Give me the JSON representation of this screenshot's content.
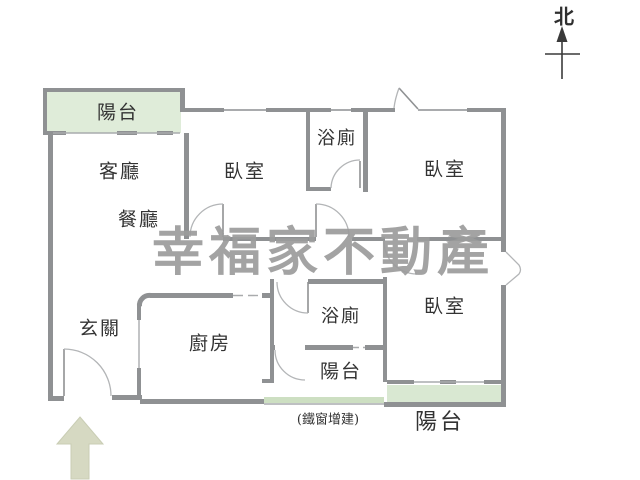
{
  "compass": {
    "label": "北"
  },
  "watermark": {
    "text": "幸福家不動產"
  },
  "rooms": {
    "balcony_top": "陽台",
    "living": "客廳",
    "dining": "餐廳",
    "bedroom_top_left": "臥室",
    "bath_top": "浴廁",
    "bedroom_top_right": "臥室",
    "entry": "玄關",
    "kitchen": "廚房",
    "bath_bottom": "浴廁",
    "balcony_small": "陽台",
    "bedroom_bottom_right": "臥室",
    "iron_window_note": "(鐵窗增建)",
    "balcony_bottom": "陽台"
  },
  "colors": {
    "wall": "#8f9193",
    "wall_light": "#a9abad",
    "balcony_green": "#dfecd9",
    "balcony_green2": "#d9e8d2",
    "strip_green": "#cddfc2",
    "arrow_green": "#d6d9c2",
    "label": "#333333",
    "watermark": "#9c9c9c",
    "compass": "#2f2f2f"
  }
}
